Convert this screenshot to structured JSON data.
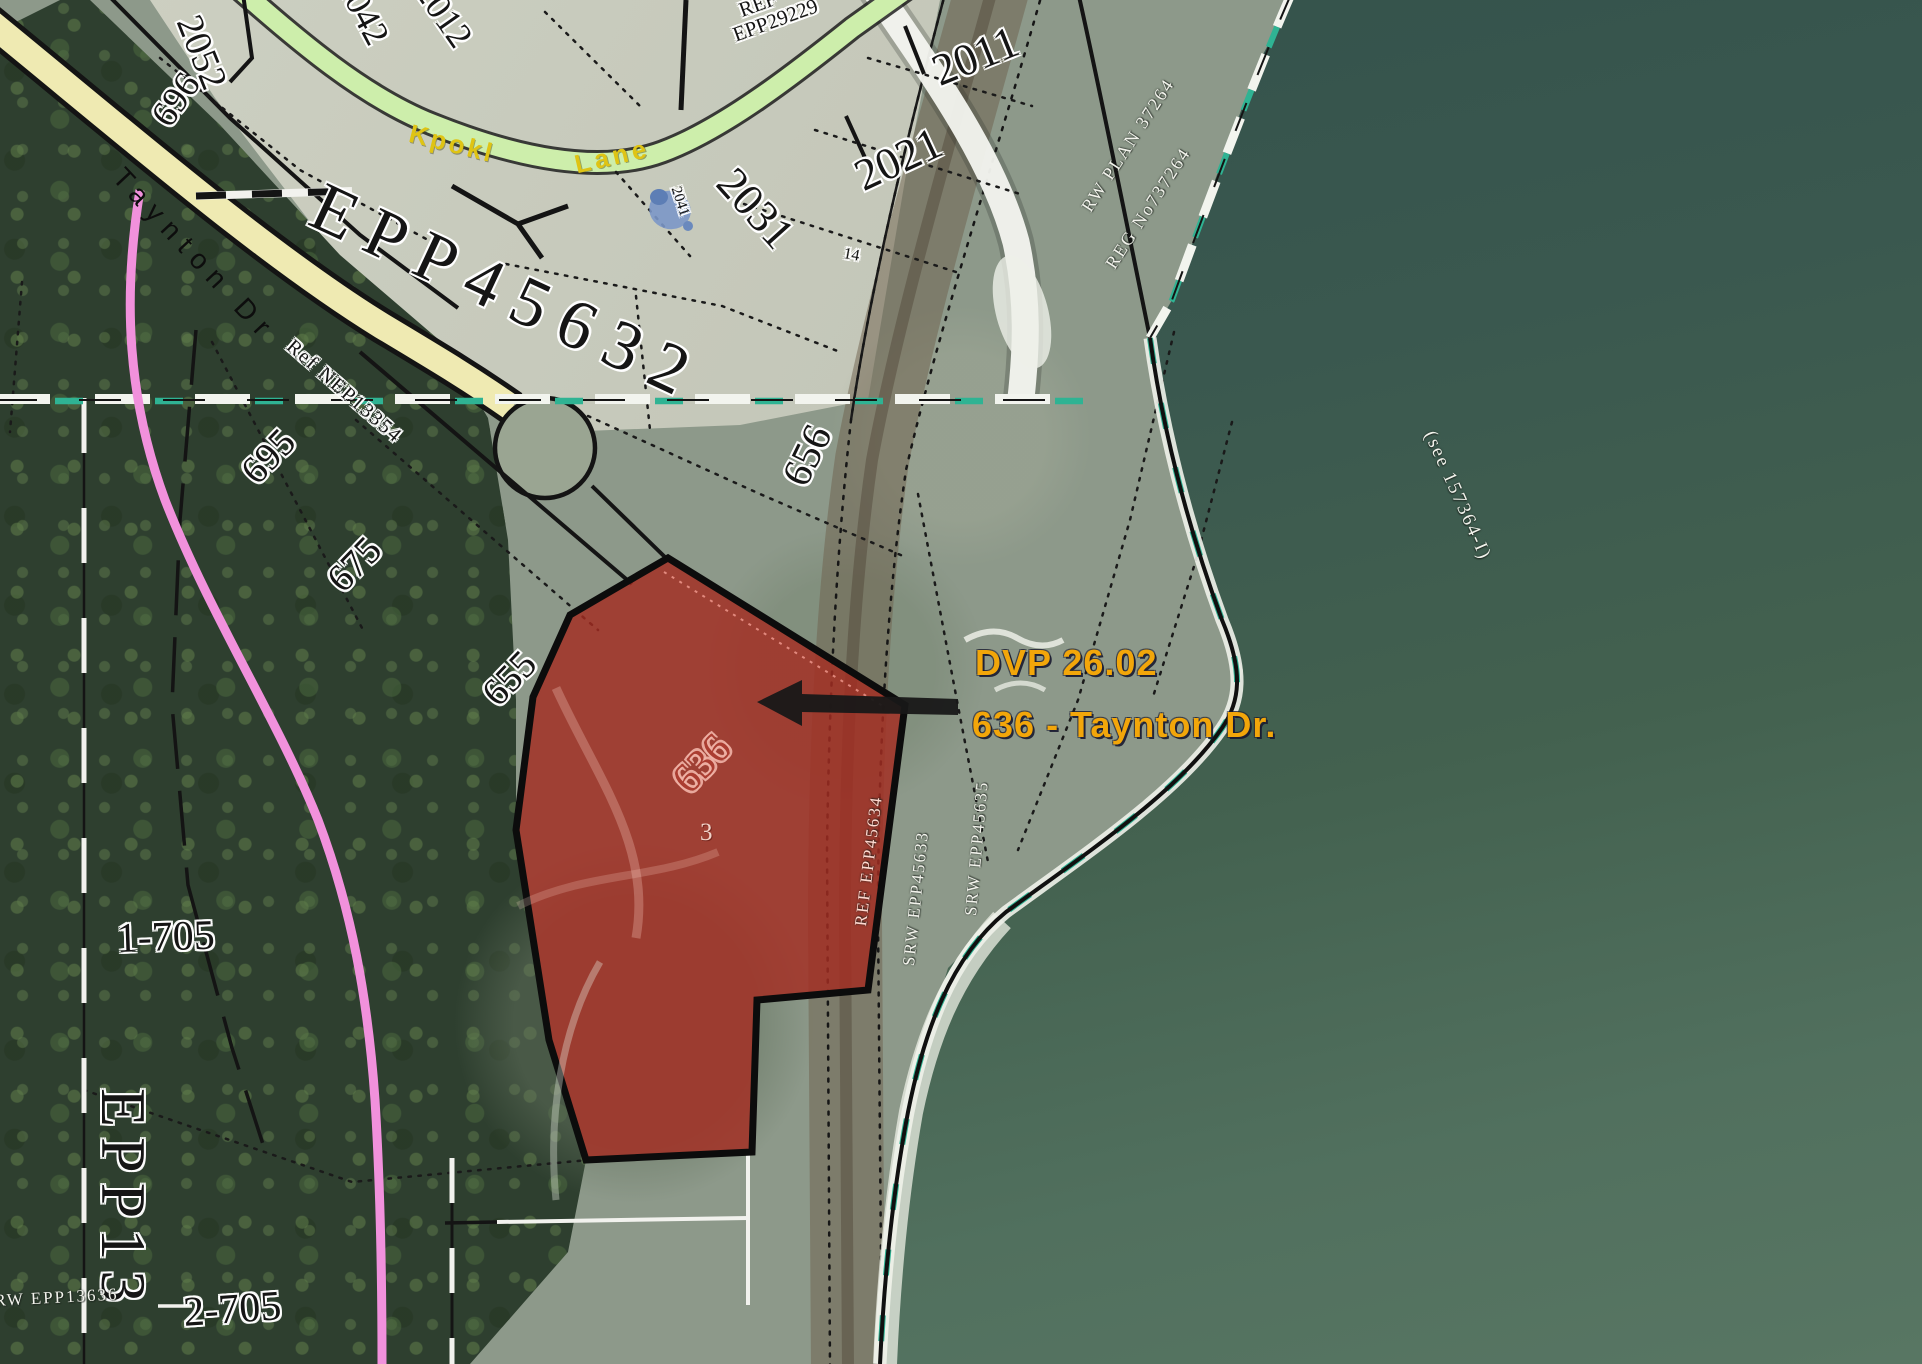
{
  "callout": {
    "line1": "DVP 26.02",
    "line2": "636 - Taynton Dr."
  },
  "roads": {
    "taynton": "Taynton Dr",
    "kpokl_word1": "Kpokl",
    "kpokl_word2": "Lane"
  },
  "plans": {
    "subdivision": "EPP45632",
    "ref_top_line1": "REF",
    "ref_top_line2": "EPP29229",
    "ref_taynton": "Ref NEP13354",
    "bottom_vertical": "EPP13",
    "bottom_small": "RW EPP13636",
    "srw_in_parcel": "REF EPP45634",
    "srw_mid": "SRW EPP45633",
    "srw_right": "SRW EPP45635",
    "railway_1": "RW PLAN 37264",
    "railway_2": "REG No737264",
    "water_note": "(see 157364-I)"
  },
  "lots": {
    "l2042": "2042",
    "l2012": "2012",
    "l2052": "2052",
    "l696": "696",
    "l2011": "2011",
    "l2021": "2021",
    "l2031": "2031",
    "l2041": "2041",
    "l14": "14",
    "l695": "695",
    "l675": "675",
    "l655": "655",
    "l656": "656",
    "l636": "636",
    "l3": "3",
    "l1_705": "1-705",
    "l2_705": "2-705"
  },
  "colors": {
    "parcel_highlight": "#a32c22",
    "callout_text": "#f2a60a",
    "road_fill": "#efeab2",
    "lane_fill": "#cdeeab",
    "utility_pink": "#f191dc",
    "boundary_teal": "#2fb393"
  }
}
